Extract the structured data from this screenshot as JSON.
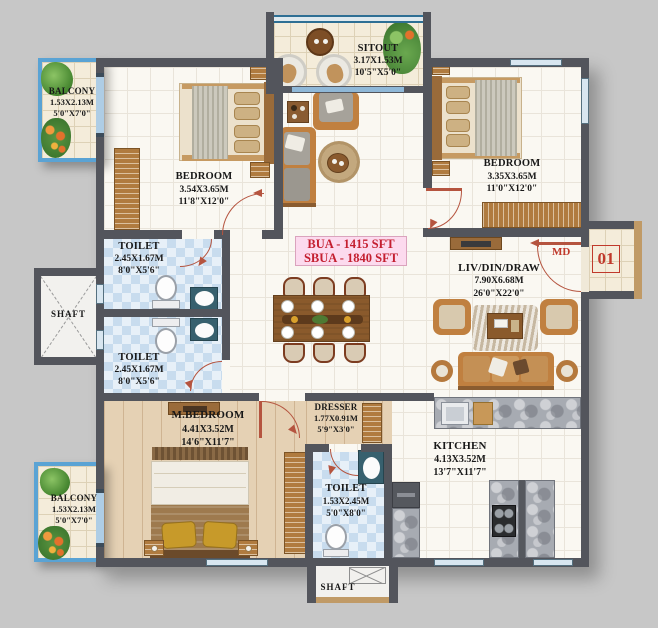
{
  "plan": {
    "area_badge": {
      "line1": "BUA - 1415 SFT",
      "line2": "SBUA - 1840 SFT"
    },
    "unit_number": "01",
    "main_door_label": "MD",
    "rooms": {
      "balcony_top": {
        "name": "BALCONY",
        "metric": "1.53X2.13M",
        "imperial": "5'0\"X7'0\""
      },
      "bedroom_left": {
        "name": "BEDROOM",
        "metric": "3.54X3.65M",
        "imperial": "11'8\"X12'0\""
      },
      "sitout": {
        "name": "SITOUT",
        "metric": "3.17X1.53M",
        "imperial": "10'5\"X5'0\""
      },
      "bedroom_right": {
        "name": "BEDROOM",
        "metric": "3.35X3.65M",
        "imperial": "11'0\"X12'0\""
      },
      "toilet_top": {
        "name": "TOILET",
        "metric": "2.45X1.67M",
        "imperial": "8'0\"X5'6\""
      },
      "toilet_mid": {
        "name": "TOILET",
        "metric": "2.45X1.67M",
        "imperial": "8'0\"X5'6\""
      },
      "shaft_left": {
        "name": "SHAFT"
      },
      "living": {
        "name": "LIV/DIN/DRAW",
        "metric": "7.90X6.68M",
        "imperial": "26'0\"X22'0\""
      },
      "master_bedroom": {
        "name": "M.BEDROOM",
        "metric": "4.41X3.52M",
        "imperial": "14'6\"X11'7\""
      },
      "dresser": {
        "name": "DRESSER",
        "metric": "1.77X0.91M",
        "imperial": "5'9\"X3'0\""
      },
      "toilet_master": {
        "name": "TOILET",
        "metric": "1.53X2.45M",
        "imperial": "5'0\"X8'0\""
      },
      "kitchen": {
        "name": "KITCHEN",
        "metric": "4.13X3.52M",
        "imperial": "13'7\"X11'7\""
      },
      "balcony_bottom": {
        "name": "BALCONY",
        "metric": "1.53X2.13M",
        "imperial": "5'0\"X7'0\""
      },
      "shaft_bottom": {
        "name": "SHAFT"
      }
    },
    "colors": {
      "wall": "#53555c",
      "floor": "#faf8f2",
      "toilet_tile": "#c8dcee",
      "balcony_frame": "#5aa3d4",
      "accent_red": "#c0392b",
      "badge_bg": "#fcdaee",
      "badge_text": "#c41f30",
      "door_swing": "#b5543f"
    }
  }
}
